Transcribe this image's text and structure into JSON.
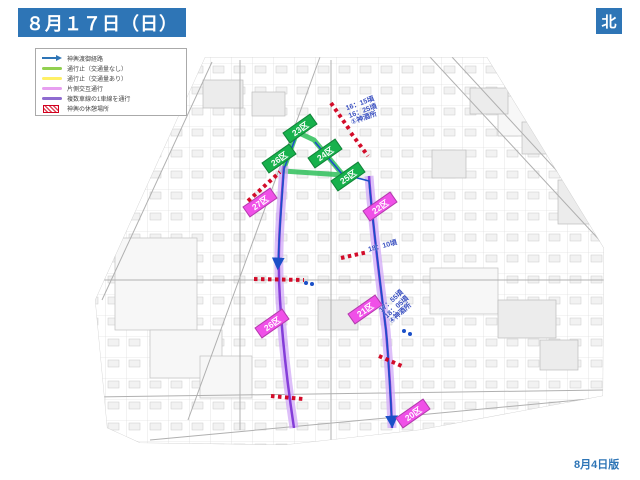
{
  "page": {
    "title": "８月１７日（日）",
    "north_label": "北",
    "edition_label": "8月4日版",
    "accent_color": "#2E75B6"
  },
  "legend": {
    "items": [
      {
        "name": "procession-route-arrow",
        "label": "神輿渡御経路",
        "color": "#2E75B6"
      },
      {
        "name": "road-closed-no-traffic",
        "label": "通行止（交通量なし）",
        "color": "#92D050"
      },
      {
        "name": "road-closed-with-traffic",
        "label": "通行止（交通量あり）",
        "color": "#FFF066"
      },
      {
        "name": "one-side-alternating-traffic",
        "label": "片側交互通行",
        "color": "#E79FF0"
      },
      {
        "name": "one-lane-of-multilane",
        "label": "複数車線の1車線を通行",
        "color": "#8E6BD0"
      },
      {
        "name": "mikoshi-rest-area",
        "label": "神輿の休憩場所",
        "color": "#D1001F"
      }
    ]
  },
  "map": {
    "green_labels": [
      {
        "text": "23区"
      },
      {
        "text": "24区"
      },
      {
        "text": "25区"
      },
      {
        "text": "26区"
      }
    ],
    "pink_labels": [
      {
        "text": "27区"
      },
      {
        "text": "22区"
      },
      {
        "text": "21区"
      },
      {
        "text": "26区"
      },
      {
        "text": "20区"
      }
    ],
    "annotations": [
      {
        "lines": [
          "16：15頃",
          "16：25頃",
          "①神酒所"
        ]
      },
      {
        "lines": [
          "18：10頃",
          "",
          ""
        ]
      },
      {
        "lines": [
          "17：55頃",
          "18：05頃",
          "④神酒所"
        ]
      }
    ],
    "colors": {
      "route_green": "#2FBF5A",
      "route_lavender": "#D2AAF7",
      "route_purple": "#7B2FD6",
      "route_blue": "#1B50C8",
      "rest_red": "#D1001F",
      "label_green": "#17B14C",
      "label_pink": "#F050E8"
    }
  }
}
